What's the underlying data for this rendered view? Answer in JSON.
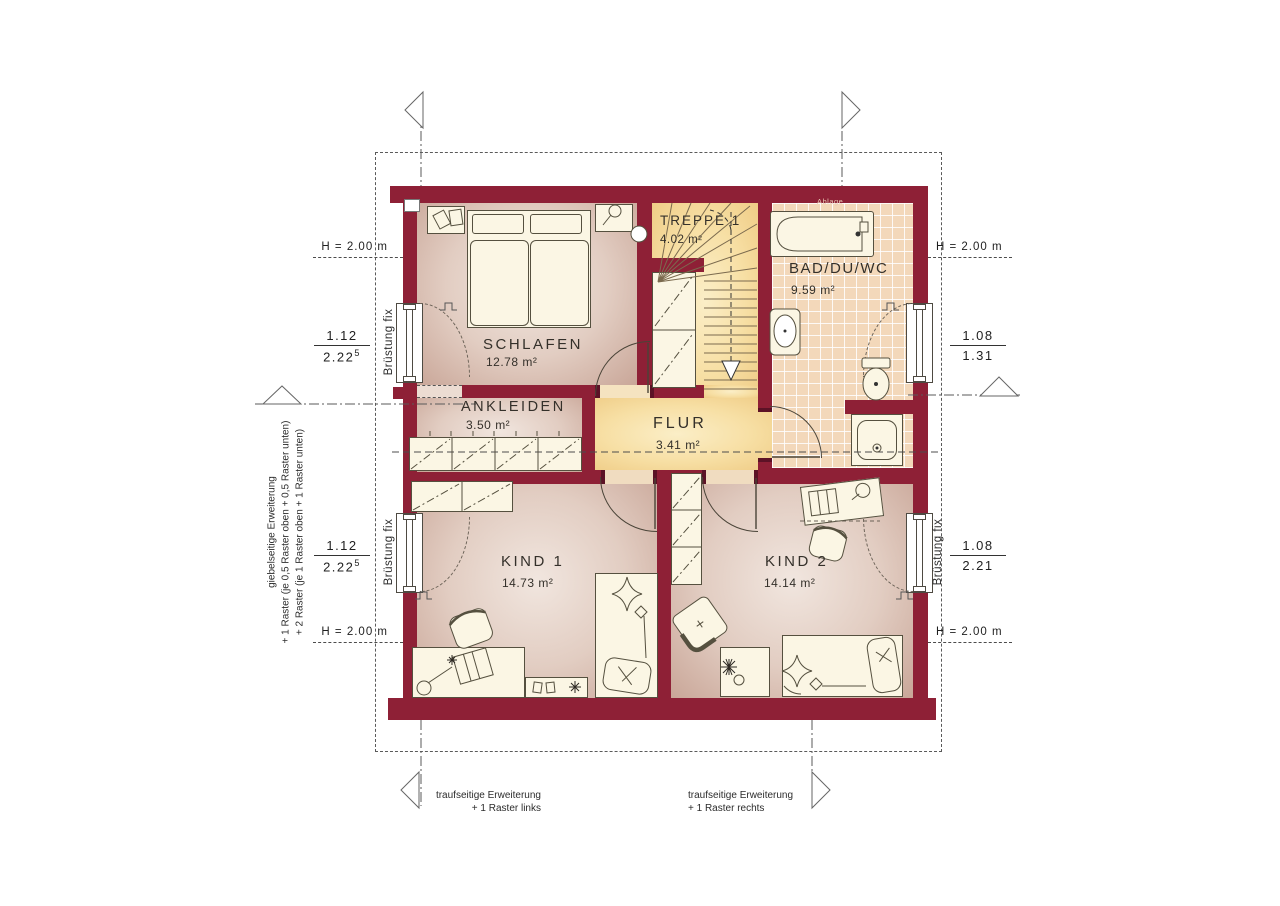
{
  "plan": {
    "rooms": {
      "schlafen": {
        "name": "SCHLAFEN",
        "area": "12.78 m²"
      },
      "ankleiden": {
        "name": "ANKLEIDEN",
        "area": "3.50 m²"
      },
      "treppe": {
        "name": "TREPPE 1",
        "area": "4.02 m²"
      },
      "bad": {
        "name": "BAD/DU/WC",
        "area": "9.59 m²"
      },
      "flur": {
        "name": "FLUR",
        "area": "3.41 m²"
      },
      "kind1": {
        "name": "KIND 1",
        "area": "14.73 m²"
      },
      "kind2": {
        "name": "KIND 2",
        "area": "14.14 m²"
      }
    },
    "fixtures": {
      "shelf_label": "Ablage"
    },
    "dimensions": {
      "height_label": "H = 2.00 m",
      "parapet_label": "Brüstung fix",
      "windows": {
        "left_top": {
          "width": "1.12",
          "height": "2.22",
          "height_sup": "5"
        },
        "left_bottom": {
          "width": "1.12",
          "height": "2.22",
          "height_sup": "5"
        },
        "right_top": {
          "width": "1.08",
          "height": "1.31"
        },
        "right_bottom": {
          "width": "1.08",
          "height": "2.21"
        }
      }
    },
    "annotations": {
      "gable_note_lines": [
        "giebelseitige Erweiterung",
        "+ 1 Raster (je 0,5 Raster oben + 0,5 Raster unten)",
        "+ 2 Raster (je 1 Raster oben + 1 Raster unten)"
      ],
      "eaves_left": {
        "line1": "traufseitige Erweiterung",
        "line2": "+ 1 Raster links"
      },
      "eaves_right": {
        "line1": "traufseitige Erweiterung",
        "line2": "+ 1 Raster rechts"
      }
    },
    "colors": {
      "wall": "#8e2036",
      "room_floor": "#e2cdc2",
      "hall_floor": "#f7dfa4",
      "tile_floor": "#f3d8ba",
      "furniture": "#fbf6e4"
    },
    "icons": {
      "grid_marker": "triangle-marker",
      "stair_direction": "down-arrow"
    }
  }
}
